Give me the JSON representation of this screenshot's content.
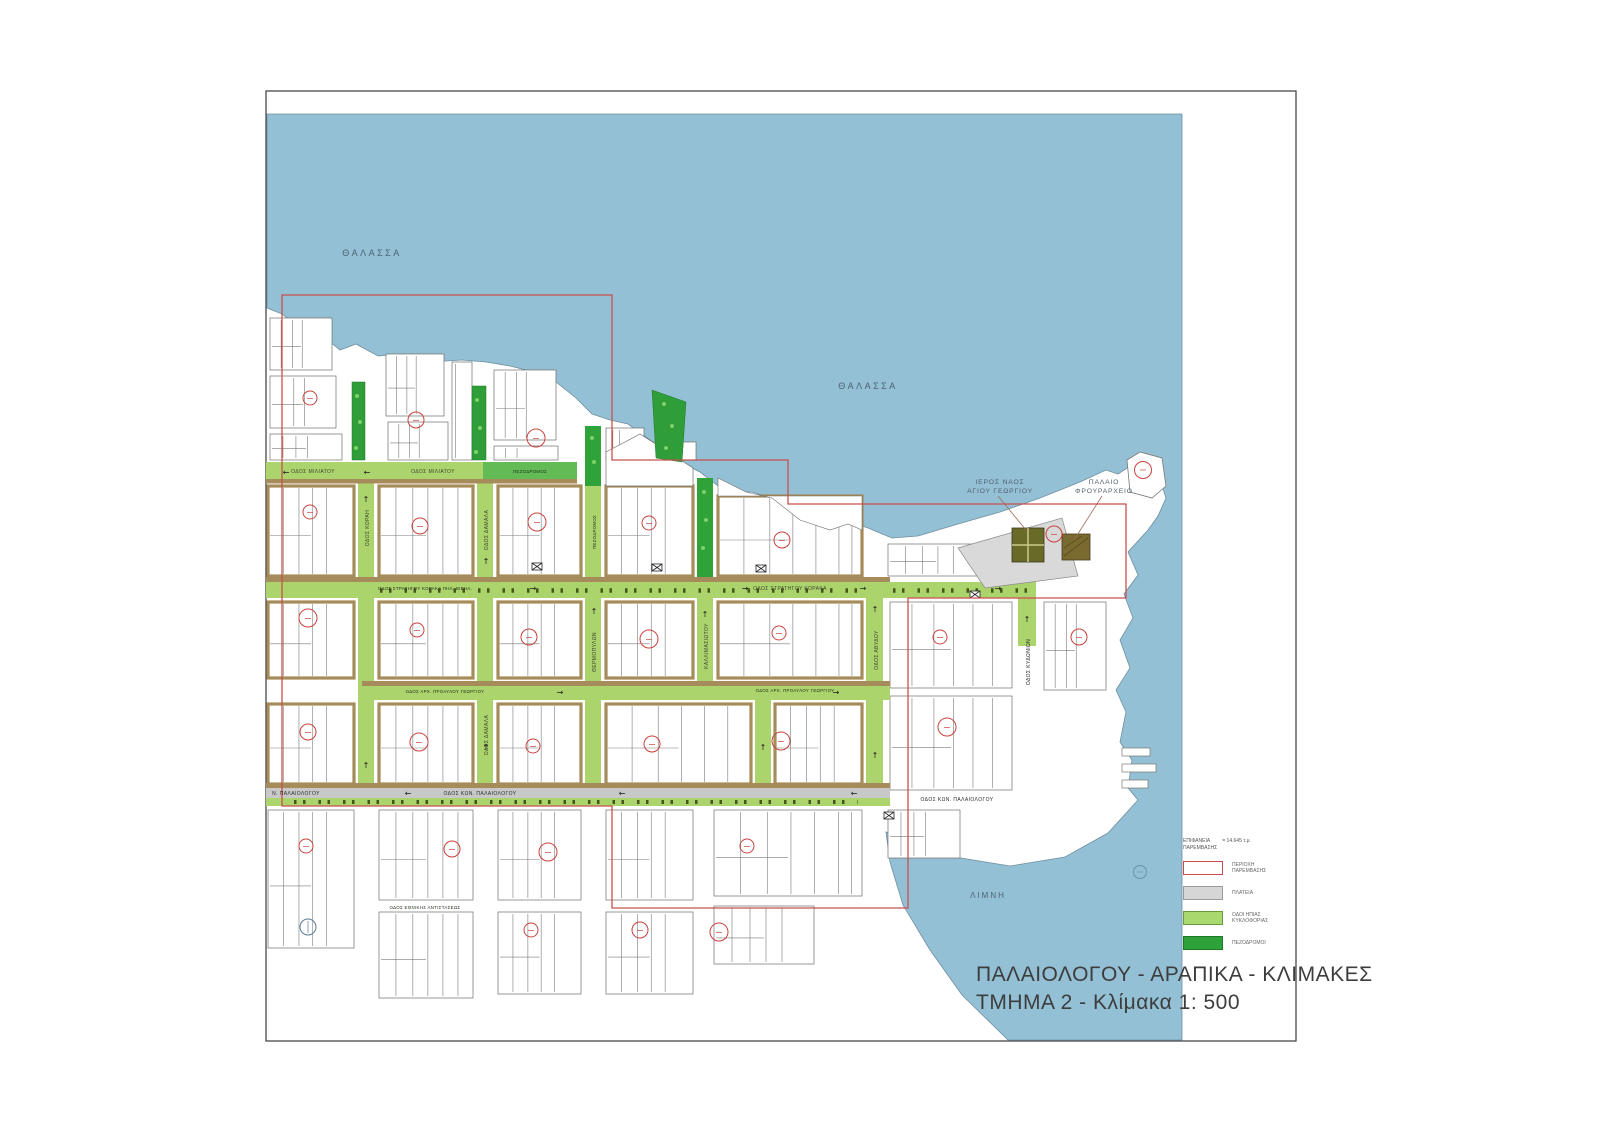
{
  "title": {
    "line1": "ΠΑΛΑΙΟΛΟΓΟΥ - ΑΡΑΠΙΚΑ - ΚΛΙΜΑΚΕΣ",
    "line2": "ΤΜΗΜΑ 2 - Κλίμακα 1: 500"
  },
  "legend": {
    "header_line1": "ΕΠΙΦΑΝΕΙΑ",
    "header_line2": "ΠΑΡΕΜΒΑΣΗΣ",
    "header_value": "= 14.645 τ.μ.",
    "items": [
      {
        "label_line1": "ΠΕΡΙΟΧΗ",
        "label_line2": "ΠΑΡΕΜΒΑΣΗΣ",
        "swatch_color": "#c8504c"
      },
      {
        "label_line1": "ΠΛΑΤΕΙΑ",
        "label_line2": "",
        "swatch_color": "#d6d6d6"
      },
      {
        "label_line1": "ΟΔΟΙ ΗΠΙΑΣ",
        "label_line2": "ΚΥΚΛΟΦΟΡΙΑΣ",
        "swatch_color": "#a9d96e"
      },
      {
        "label_line1": "ΠΕΖΟΔΡΟΜΟΙ",
        "label_line2": "",
        "swatch_color": "#2ea13a"
      }
    ]
  },
  "water_labels": {
    "sea_nw": "ΘΑΛΑΣΣΑ",
    "sea_ne": "ΘΑΛΑΣΣΑ",
    "harbor": "ΛΙΜΝΗ"
  },
  "landmarks": {
    "church_line1": "ΙΕΡΟΣ ΝΑΟΣ",
    "church_line2": "ΑΓΙΟΥ ΓΕΩΡΓΙΟΥ",
    "guardhouse_line1": "ΠΑΛΑΙΟ",
    "guardhouse_line2": "ΦΡΟΥΡΑΡΧΕΙΟ"
  },
  "streets": {
    "miliatou_1": "ΟΔΟΣ ΜΙΛΙΑΤΟΥ",
    "miliatou_2": "ΟΔΟΣ ΜΙΛΙΑΤΟΥ",
    "pezodromos_top": "ΠΕΖΟΔΡΟΜΟΣ",
    "koraka_1": "ΟΔΟΣ ΣΤΡΑΤΗΓΟΥ ΚΟΡΑΚΑ ΠΗΛ. ΒΙΒΗΛ.",
    "koraka_2": "ΟΔΟΣ ΣΤΡΑΤΗΓΟΥ ΚΟΡΑΚΑ",
    "georgiou_1": "ΟΔΟΣ ΑΡΧ. ΠΡΟΑΥΛΟΥ ΓΕΩΡΓΙΟΥ",
    "georgiou_2": "ΟΔΟΣ ΑΡΧ. ΠΡΟΑΥΛΟΥ ΓΕΩΡΓΙΟΥ",
    "palaiologou_left": "Ν. ΠΑΛΑΙΟΛΟΓΟΥ",
    "palaiologou_mid": "ΟΔΟΣ ΚΩΝ. ΠΑΛΑΙΟΛΟΓΟΥ",
    "palaiologou_right": "ΟΔΟΣ ΚΩΝ. ΠΑΛΑΙΟΛΟΓΟΥ",
    "korai": "ΟΔΟΣ ΚΟΡΑΗ",
    "damala_1": "ΟΔΟΣ ΔΑΜΑΛΑ",
    "damala_2": "ΟΔΟΣ ΔΑΜΑΛΑ",
    "pezodromos_v": "ΠΕΖΟΔΡΟΜΟΣ",
    "thermopylon": "ΘΕΡΜΟΠΥΛΩΝ",
    "kallimasiotou": "ΚΑΛΛΙΜΑΣΙΩΤΟΥ",
    "avydou": "ΟΔΟΣ ΑΒΥΔΟΥ",
    "kydonion": "ΟΔΟΣ ΚΥΔΩΝΙΩΝ",
    "south_street": "ΟΔΟΣ ΕΘΝΙΚΗΣ ΑΝΤΙΣΤΑΣΕΩΣ"
  },
  "symbols": {
    "arrow_left": "←",
    "arrow_right": "→",
    "arrow_up": "↑"
  },
  "colors": {
    "sea": "#93c0d5",
    "road_calm": "#acd46c",
    "road_pedestrian": "#2fa23a",
    "road_gray": "#c8c8c8",
    "road_edge_tan": "#a58c5a",
    "plaza": "#d9d9d9",
    "boundary_red": "#c8504c",
    "marker_red": "#c9423d"
  }
}
